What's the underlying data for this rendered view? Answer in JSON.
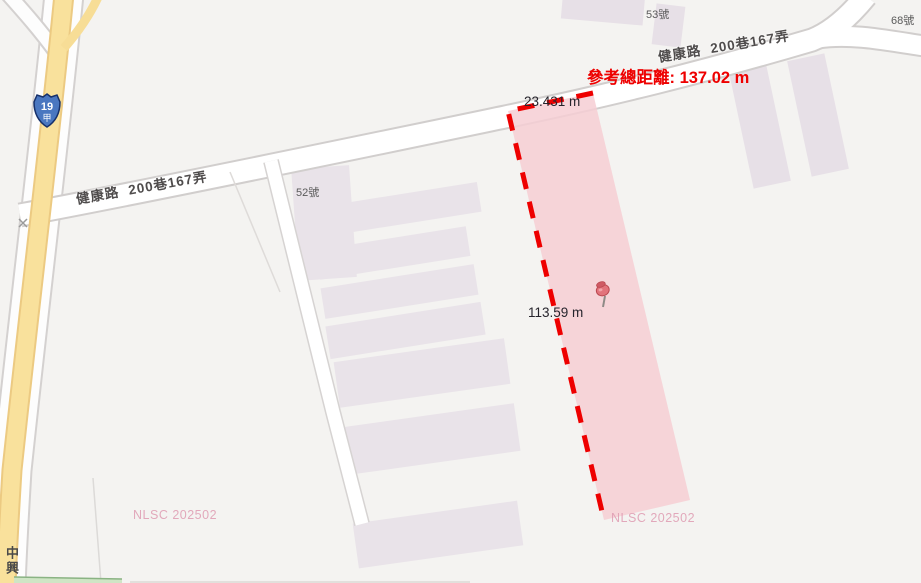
{
  "map": {
    "measurement": {
      "total": "參考總距離: 137.02 m",
      "segment_top": "23.431 m",
      "segment_left": "113.59 m"
    },
    "road_labels": {
      "west": "健康路  200巷167弄",
      "northeast": "健康路  200巷167弄"
    },
    "house_numbers": {
      "n52": "52號",
      "n53": "53號",
      "n68": "68號"
    },
    "street_vertical": "中興",
    "highway_shield": {
      "number": "19",
      "suffix": "甲"
    },
    "watermark": "NLSC 202502",
    "colors": {
      "accent_red": "#ee0000",
      "parcel_fill": "#f6ced4",
      "road_yellow": "#f9e19c",
      "building": "#e7e0e7",
      "watermark_pink": "#df9cb2",
      "background": "#f4f3f1",
      "shield_blue": "#4a77c0"
    }
  }
}
